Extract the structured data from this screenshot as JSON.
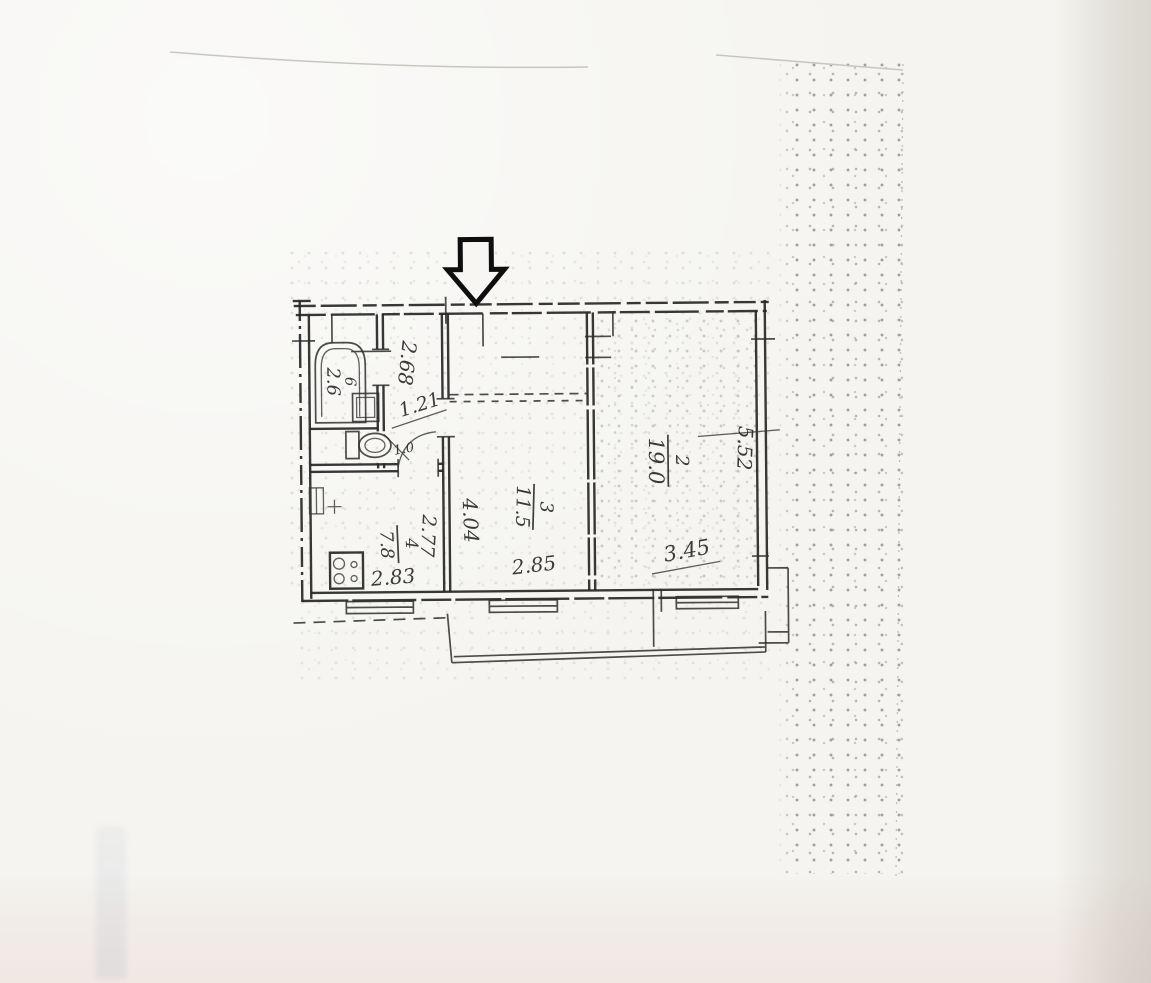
{
  "document": {
    "kind": "scanned apartment floor plan",
    "colors": {
      "paper": "#f5f4f0",
      "ink": "#262626",
      "shade_right": "#e9e6de",
      "tint_bottom": "#f3ebe8"
    }
  },
  "icons": {
    "entrance_arrow": "down-arrow-icon"
  },
  "plan": {
    "rooms": {
      "living_room": {
        "number": "2",
        "area": "19.0",
        "width": "3.45",
        "depth": "5.52"
      },
      "bedroom": {
        "number": "3",
        "area": "11.5",
        "width": "2.85",
        "depth": "4.04"
      },
      "kitchen": {
        "number": "4",
        "area": "7.8",
        "width": "2.83",
        "depth": "2.77"
      },
      "bathroom": {
        "number": "6",
        "area": "2.6"
      },
      "wc": {
        "area": "1.0"
      },
      "hall": {
        "depth": "2.68",
        "width": "1.21"
      }
    }
  }
}
